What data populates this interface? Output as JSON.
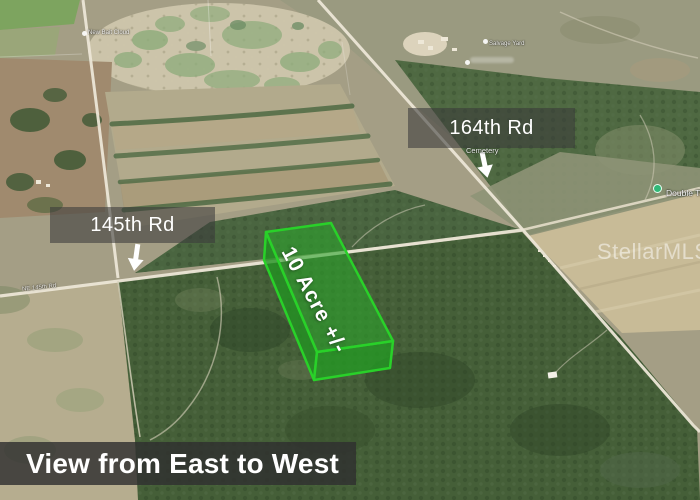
{
  "annotations": {
    "road_label_top": "164th Rd",
    "road_label_left": "145th Rd",
    "parcel_label": "10 Acre +/-",
    "caption": "View from East to West",
    "watermark": "StellarMLS"
  },
  "map_labels": {
    "poi_pin": "Double Ta",
    "cemetery": "Cemetery",
    "salvage_yard": "Salvage Yard",
    "poi_topleft": "New Bait Cloud",
    "road_name_small": "NE 145th Rd"
  },
  "colors": {
    "parcel_fill": "#2ca42c",
    "parcel_stroke": "#29d129",
    "label_band_bg": "#3a3a3a",
    "caption_bg": "#303030",
    "annotation_text": "#ffffff",
    "pin_green": "#31b878"
  }
}
